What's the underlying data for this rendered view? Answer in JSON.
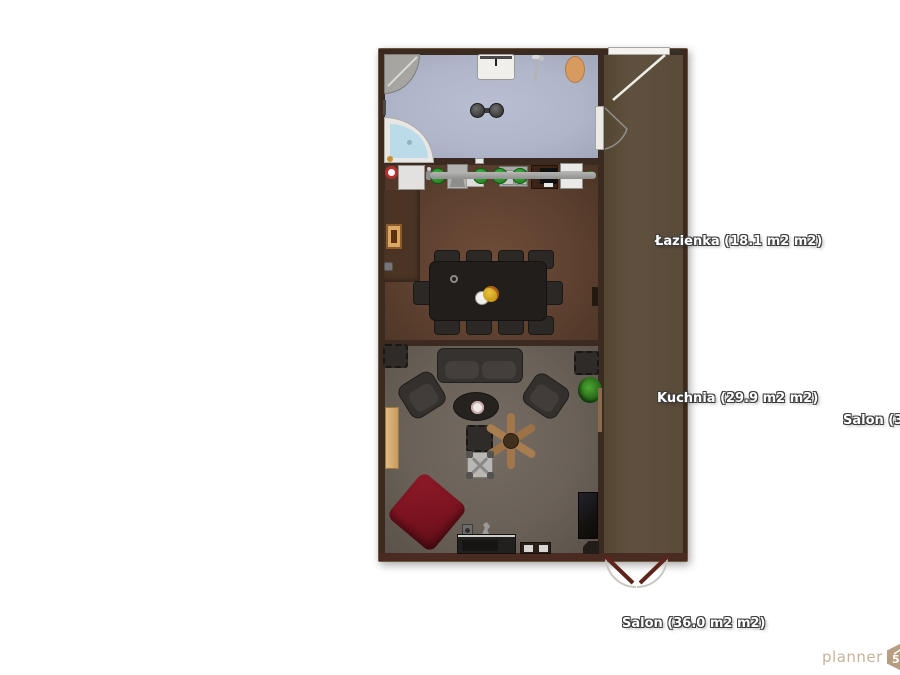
{
  "canvas": {
    "background": "#ffffff"
  },
  "floorplan": {
    "wall_color": "#3a2a1f",
    "rooms": {
      "bathroom": {
        "name": "Łazienka",
        "area": "18.1 m2",
        "label": "Łazienka (18.1 m2 m2)",
        "floor_color": "#b4bacd"
      },
      "kitchen": {
        "name": "Kuchnia",
        "area": "29.9 m2",
        "label": "Kuchnia (29.9 m2 m2)",
        "floor_color": "#5f4331"
      },
      "salon": {
        "name": "Salon",
        "area": "36.0 m2",
        "label": "Salon (36.0 m2 m2)",
        "floor_color": "#6e655c"
      },
      "salon_right": {
        "name": "Salon",
        "label_partial": "Salon (3",
        "floor_color": "#5b4d3a"
      }
    },
    "accents": {
      "stool_green": "#2e8b2e",
      "beanbag_red": "#7e1522",
      "wood": "#a5794c",
      "door_red": "#5d241b"
    }
  },
  "watermark": {
    "brand": "planner",
    "badge": "5d",
    "color": "#c7b299"
  }
}
